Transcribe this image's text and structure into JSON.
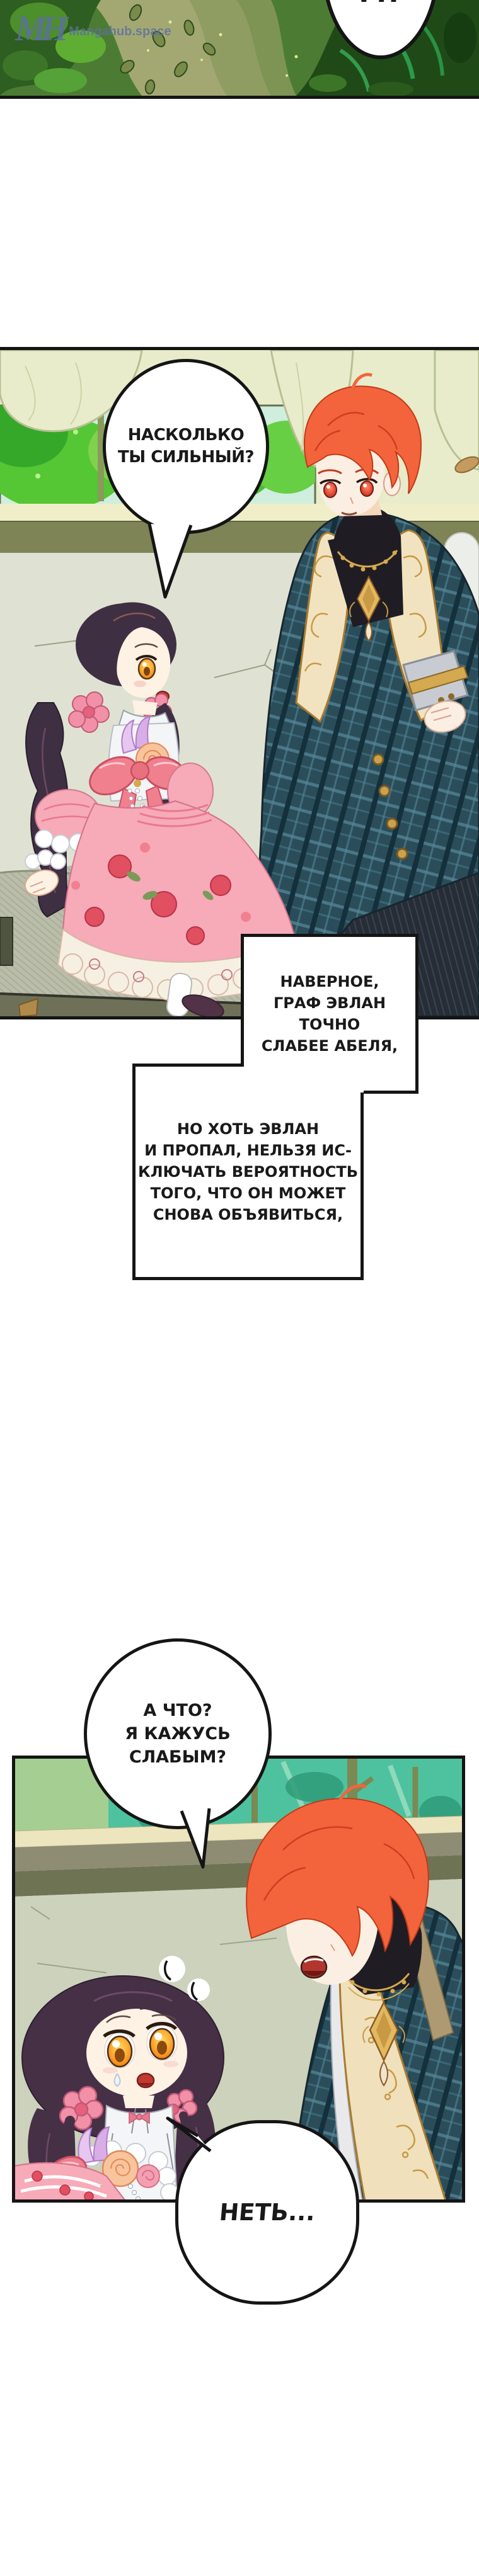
{
  "watermark": {
    "logo": "MH",
    "site": "Mangahub.space"
  },
  "speech": {
    "hm": {
      "text": "М?"
    },
    "how_strong": {
      "lines": [
        "НАСКОЛЬКО",
        "ТЫ СИЛЬНЫЙ?"
      ]
    },
    "do_i_seem_weak": {
      "lines": [
        "А ЧТО?",
        "Я КАЖУСЬ",
        "СЛАБЫМ?"
      ]
    },
    "no": {
      "text": "НЕТЬ..."
    }
  },
  "narration": {
    "box1": {
      "lines": [
        "НАВЕРНОЕ,",
        "ГРАФ ЭВЛАН ТОЧНО",
        "СЛАБЕЕ АБЕЛЯ,"
      ]
    },
    "box2": {
      "lines": [
        "НО ХОТЬ ЭВЛАН",
        "И ПРОПАЛ, НЕЛЬЗЯ ИС-",
        "КЛЮЧАТЬ ВЕРОЯТНОСТЬ",
        "ТОГО, ЧТО ОН МОЖЕТ",
        "СНОВА ОБЪЯВИТЬСЯ,"
      ]
    }
  },
  "colors": {
    "bubble_border": "#151515",
    "watermark_blue": "#5e6f9e",
    "forest_dark": "#1f4a18",
    "forest_bright": "#63b23a",
    "curtain_green": "#e8ecca",
    "couch_sage": "#dfe2d2",
    "window_teal": "#4ec29e",
    "man_hair_red": "#f4643c",
    "plaid_teal": "#2b4d5a",
    "gold": "#d4a94f",
    "girl_hair_plum": "#463046",
    "dress_pink": "#f7aab8",
    "bow_coral": "#f0808e",
    "eye_orange": "#ffaf33"
  }
}
